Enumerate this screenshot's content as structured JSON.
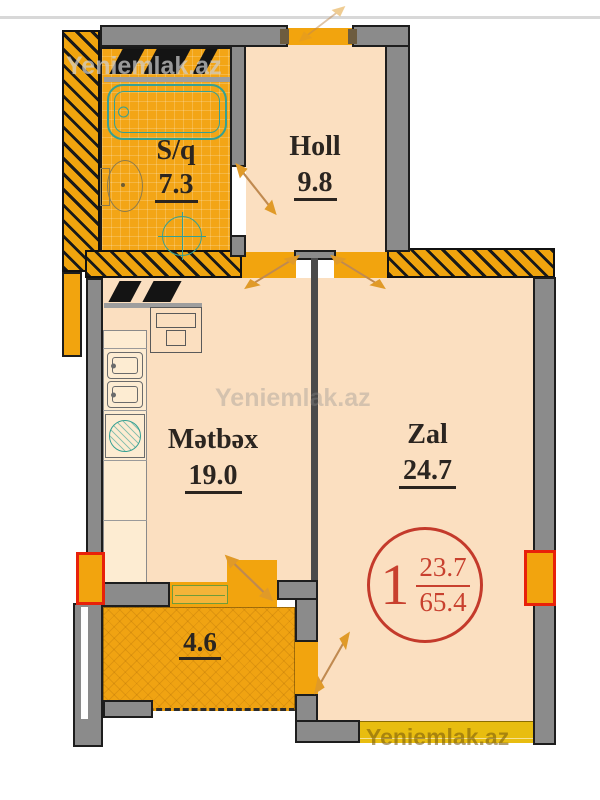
{
  "watermark": {
    "text": "Yeniemlak.az"
  },
  "rooms": {
    "bathroom": {
      "name": "S/q",
      "area": "7.3"
    },
    "hall": {
      "name": "Holl",
      "area": "9.8"
    },
    "kitchen": {
      "name": "Mətbəx",
      "area": "19.0"
    },
    "living": {
      "name": "Zal",
      "area": "24.7"
    },
    "balcony": {
      "area": "4.6"
    }
  },
  "badge": {
    "room_count": "1",
    "living_area": "23.7",
    "total_area": "65.4"
  },
  "colors": {
    "wall_gray": "#8b8b8b",
    "accent_orange": "#f2a40e",
    "room_fill": "#fbdfc0",
    "balcony_fill": "#f0a312",
    "window_red": "#e8210a",
    "badge_red": "#c43a2b"
  }
}
